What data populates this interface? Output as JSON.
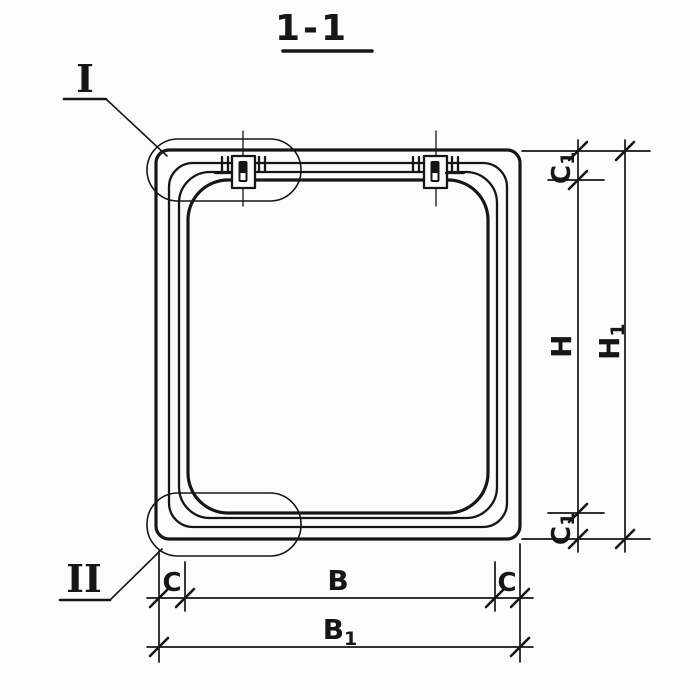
{
  "title": {
    "text": "1-1"
  },
  "callouts": {
    "detail_one": "I",
    "detail_two": "II"
  },
  "dimensions": {
    "c1_top": {
      "main": "C",
      "sub": "1"
    },
    "h": {
      "main": "H",
      "sub": ""
    },
    "c1_bottom": {
      "main": "C",
      "sub": "1"
    },
    "h1": {
      "main": "H",
      "sub": "1"
    },
    "c_left": {
      "main": "C",
      "sub": ""
    },
    "b": {
      "main": "B",
      "sub": ""
    },
    "c_right": {
      "main": "C",
      "sub": ""
    },
    "b1": {
      "main": "B",
      "sub": "1"
    }
  },
  "colors": {
    "ink": "#161616",
    "paper": "#fcfcfc"
  }
}
